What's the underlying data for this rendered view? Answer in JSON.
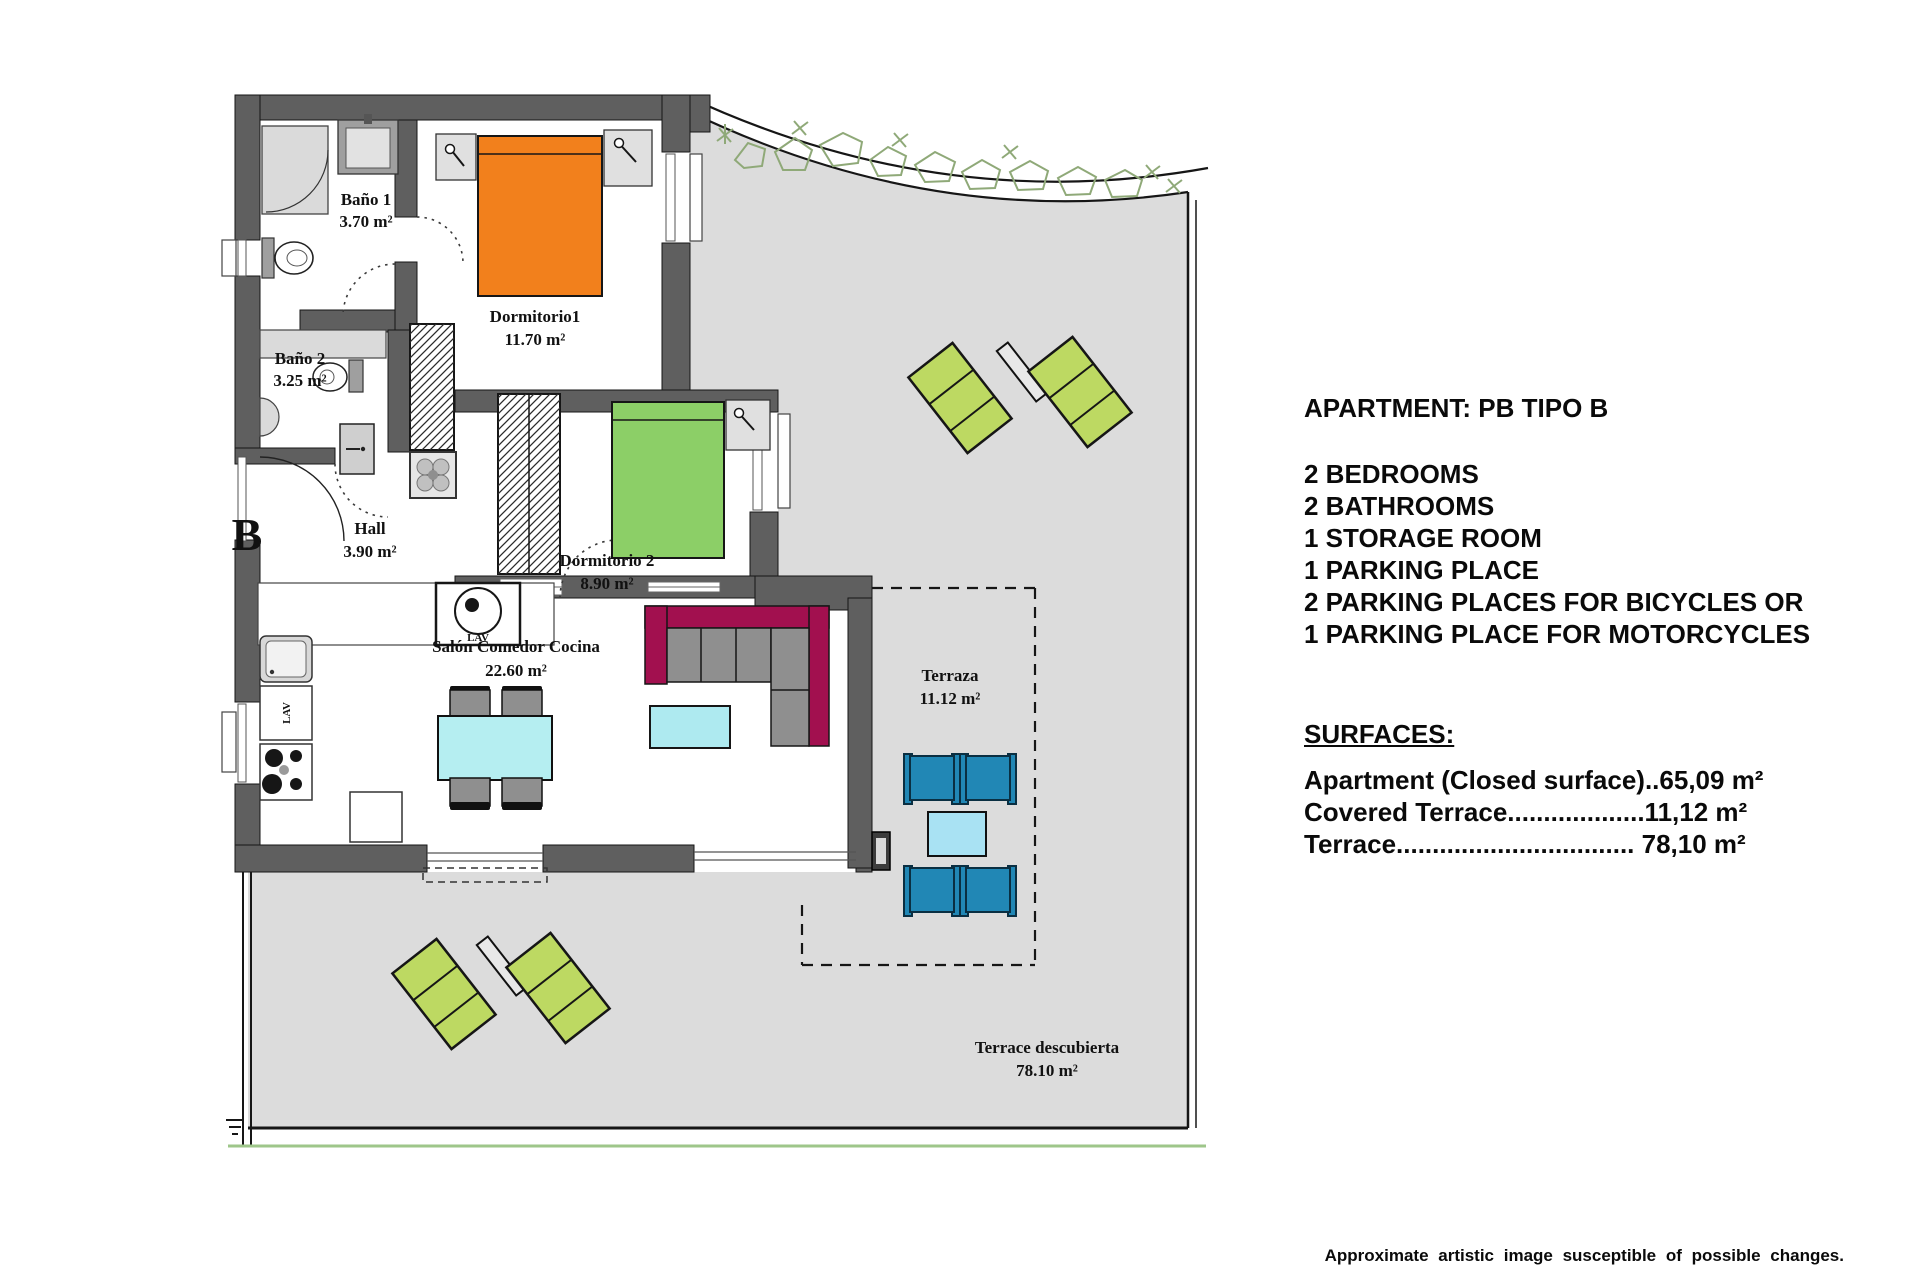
{
  "panel": {
    "title": "APARTMENT: PB TIPO B",
    "features": [
      "2 BEDROOMS",
      "2 BATHROOMS",
      "1 STORAGE ROOM",
      "1 PARKING PLACE",
      "2 PARKING PLACES FOR BICYCLES OR",
      "1 PARKING PLACE FOR MOTORCYCLES"
    ],
    "surfaces_heading": "SURFACES:",
    "surfaces": [
      "Apartment (Closed surface)..65,09 m²",
      "Covered Terrace...................11,12 m²",
      "Terrace................................. 78,10 m²"
    ]
  },
  "plan": {
    "block_letter": "B",
    "appliance_label": "LAV",
    "rooms": {
      "bano1": {
        "name": "Baño 1",
        "area": "3.70 m²"
      },
      "bano2": {
        "name": "Baño 2",
        "area": "3.25 m²"
      },
      "dormitorio1": {
        "name": "Dormitorio1",
        "area": "11.70 m²"
      },
      "dormitorio2": {
        "name": "Dormitorio 2",
        "area": "8.90 m²"
      },
      "hall": {
        "name": "Hall",
        "area": "3.90 m²"
      },
      "salon": {
        "name": "Salón Comedor Cocina",
        "area": "22.60 m²"
      },
      "terraza": {
        "name": "Terraza",
        "area": "11.12 m²"
      },
      "terrace_descubierta": {
        "name": "Terrace descubierta",
        "area": "78.10 m²"
      }
    },
    "colors": {
      "wall": "#5f5f5f",
      "terrace_floor": "#dcdcdc",
      "bed_orange": "#f2801c",
      "bed_green": "#8ccf67",
      "lounger_green": "#bdd962",
      "sofa_magenta": "#a2104f",
      "chair_blue": "#2187b5",
      "side_table_blue": "#a9e2f3",
      "dining_table_cyan": "#b5eef1",
      "plant_green": "#8fa978"
    }
  },
  "disclaimer": "Approximate artistic image susceptible of possible changes."
}
